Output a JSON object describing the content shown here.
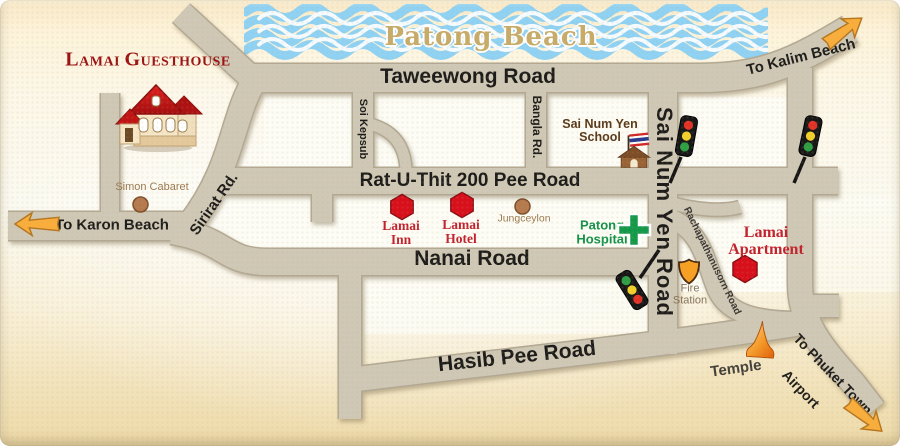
{
  "map": {
    "region_label": "Patong Beach"
  },
  "logo": {
    "line1": "Lamai",
    "line2": "Guesthouse"
  },
  "roads": {
    "taweewong": "Taweewong Road",
    "rat_u_thit": "Rat-U-Thit 200 Pee Road",
    "nanai": "Nanai Road",
    "hasib_pee": "Hasib Pee Road",
    "soi_kepsub": "Soi Kepsub",
    "bangla": "Bangla Rd.",
    "sirirat": "Sirirat Rd.",
    "sai_num_yen": "Sai Num Yen Road",
    "rachapathanusorn": "Rachapathanusorn Road",
    "to_karon": "To Karon Beach",
    "to_kalim": "To Kalim Beach",
    "to_phuket_line1": "To Phuket Town",
    "to_phuket_line2": "Airport"
  },
  "pois": {
    "simon_cabaret": "Simon Cabaret",
    "lamai_inn": {
      "line1": "Lamai",
      "line2": "Inn"
    },
    "lamai_hotel": {
      "line1": "Lamai",
      "line2": "Hotel"
    },
    "jungceylon": "Jungceylon",
    "patong_hospital": {
      "line1": "Patong",
      "line2": "Hospital"
    },
    "school": {
      "line1": "Sai Num Yen",
      "line2": "School"
    },
    "fire_station": {
      "line1": "Fire",
      "line2": "Station"
    },
    "lamai_apartment": {
      "line1": "Lamai",
      "line2": "Apartment"
    },
    "temple": "Temple"
  },
  "colors": {
    "road_fill": "#cfc8b6",
    "road_edge": "#b2a893",
    "water_blue": "#8fd2f4",
    "beach_text": "#c6ab69",
    "brand_red": "#9b1111",
    "poi_red": "#c2222e",
    "marker_red": "#d8101c",
    "hospital_green": "#12924a",
    "arrow_orange": "#f9ae3c",
    "label_dark": "#1d1c1a",
    "poi_brown": "#9b7a50"
  }
}
